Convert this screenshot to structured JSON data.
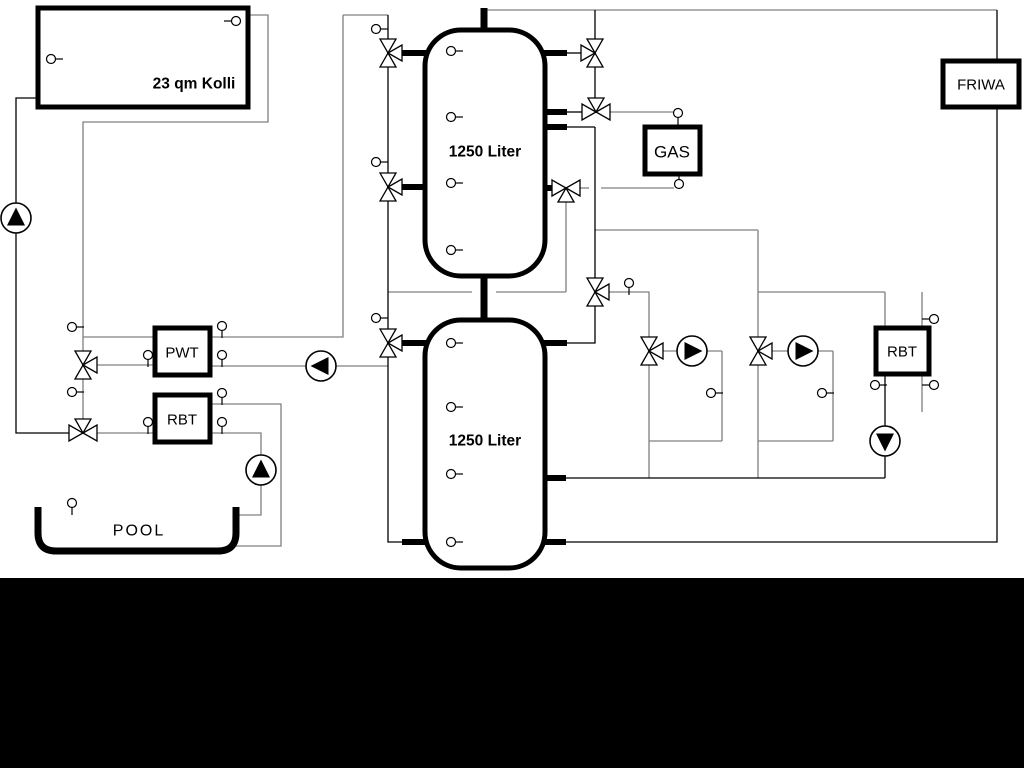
{
  "diagram": {
    "type": "hydraulic-heating-schematic",
    "collector": {
      "label": "23 qm Kolli"
    },
    "tank_top": {
      "label": "1250 Liter"
    },
    "tank_bottom": {
      "label": "1250 Liter"
    },
    "gas_boiler": {
      "label": "GAS"
    },
    "friwa": {
      "label": "FRIWA"
    },
    "pwt": {
      "label": "PWT"
    },
    "rbt_left": {
      "label": "RBT"
    },
    "rbt_right": {
      "label": "RBT"
    },
    "pool": {
      "label": "POOL"
    },
    "icons": {
      "pump": "circle with solid flow triangle",
      "three_way_valve": "bowtie double triangle with third port triangle",
      "sensor": "small circle with stem"
    },
    "colors": {
      "pipe_gray": "#808080",
      "pipe_black": "#000000",
      "background": "#ffffff",
      "bottom_bar": "#000000"
    }
  }
}
